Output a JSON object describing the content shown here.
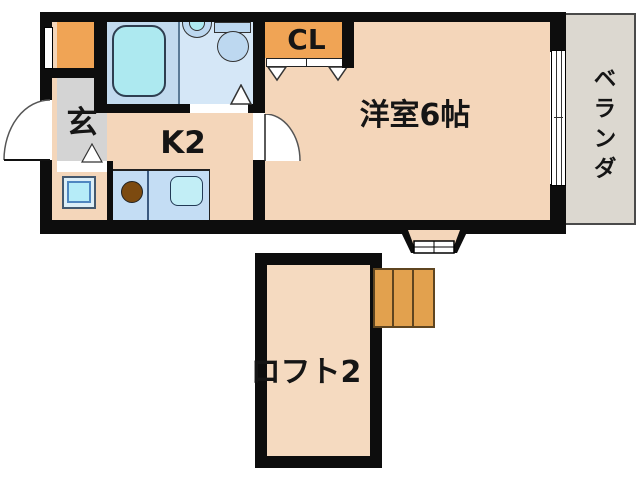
{
  "title": "apartment-floor-plan",
  "labels": {
    "entrance": "玄",
    "kitchen": "K2",
    "closet": "CL",
    "main_room": "洋室6帖",
    "veranda": "ベランダ",
    "loft": "ロフト2"
  },
  "fixtures": {
    "bathtub": "bathtub-icon",
    "washbasin": "washbasin-icon",
    "toilet": "toilet-icon",
    "range_burner": "range-burner-icon",
    "kitchen_sink": "kitchen-sink-icon",
    "washing_machine": "washing-machine-icon",
    "stairs": "stairs-icon",
    "entrance_door": "entrance-door-arc-icon",
    "room_door": "room-door-arc-icon",
    "closet_doors": "closet-door-markers",
    "bay_window": "bay-window-icon",
    "balcony_window": "balcony-window-icon",
    "entry_window": "entry-window-icon"
  },
  "colors": {
    "wall": "#0d0d0d",
    "room": "#f4d6ba",
    "loft": "#f5dac0",
    "bath": "#d5e7f7",
    "bathwet": "#c2daee",
    "tub": "#ade9f0",
    "fixture": "#bdd8f0",
    "counter": "#c4ddf4",
    "csink": "#c2eef6",
    "burner": "#7c4a10",
    "orange": "#f0a455",
    "stairs": "#e2a14e",
    "stairsedge": "#5f4520",
    "entrance": "#d4d4d4",
    "veranda": "#dcd8d0"
  }
}
